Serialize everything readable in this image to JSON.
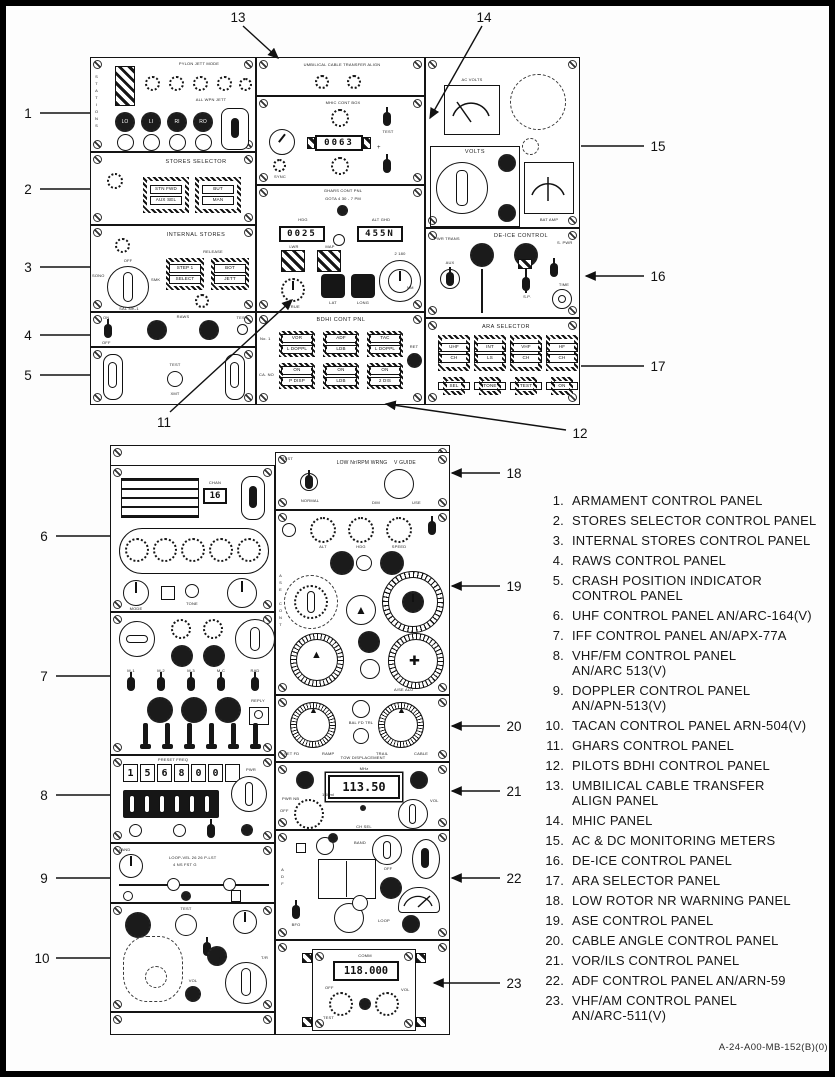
{
  "doc": {
    "footer_code": "A-24-A00-MB-152(B)(0)"
  },
  "callouts": [
    "1",
    "2",
    "3",
    "4",
    "5",
    "6",
    "7",
    "8",
    "9",
    "10",
    "11",
    "12",
    "13",
    "14",
    "15",
    "16",
    "17",
    "18",
    "19",
    "20",
    "21",
    "22",
    "23"
  ],
  "legend": {
    "items": [
      {
        "num": "1.",
        "l1": "ARMAMENT CONTROL PANEL",
        "l2": ""
      },
      {
        "num": "2.",
        "l1": "STORES SELECTOR CONTROL PANEL",
        "l2": ""
      },
      {
        "num": "3.",
        "l1": "INTERNAL STORES CONTROL PANEL",
        "l2": ""
      },
      {
        "num": "4.",
        "l1": "RAWS CONTROL PANEL",
        "l2": ""
      },
      {
        "num": "5.",
        "l1": "CRASH POSITION INDICATOR",
        "l2": "CONTROL PANEL"
      },
      {
        "num": "6.",
        "l1": "UHF CONTROL PANEL AN/ARC-164(V)",
        "l2": ""
      },
      {
        "num": "7.",
        "l1": "IFF CONTROL PANEL AN/APX-77A",
        "l2": ""
      },
      {
        "num": "8.",
        "l1": "VHF/FM CONTROL PANEL",
        "l2": "AN/ARC 513(V)"
      },
      {
        "num": "9.",
        "l1": "DOPPLER CONTROL PANEL",
        "l2": "AN/APN-513(V)"
      },
      {
        "num": "10.",
        "l1": "TACAN CONTROL PANEL ARN-504(V)",
        "l2": ""
      },
      {
        "num": "11.",
        "l1": "GHARS CONTROL PANEL",
        "l2": ""
      },
      {
        "num": "12.",
        "l1": "PILOTS BDHI CONTROL PANEL",
        "l2": ""
      },
      {
        "num": "13.",
        "l1": "UMBILICAL CABLE TRANSFER",
        "l2": "ALIGN PANEL"
      },
      {
        "num": "14.",
        "l1": "MHIC PANEL",
        "l2": ""
      },
      {
        "num": "15.",
        "l1": "AC & DC MONITORING METERS",
        "l2": ""
      },
      {
        "num": "16.",
        "l1": "DE-ICE CONTROL PANEL",
        "l2": ""
      },
      {
        "num": "17.",
        "l1": "ARA SELECTOR PANEL",
        "l2": ""
      },
      {
        "num": "18.",
        "l1": "LOW ROTOR NR WARNING PANEL",
        "l2": ""
      },
      {
        "num": "19.",
        "l1": "ASE CONTROL PANEL",
        "l2": ""
      },
      {
        "num": "20.",
        "l1": "CABLE ANGLE CONTROL PANEL",
        "l2": ""
      },
      {
        "num": "21.",
        "l1": "VOR/ILS CONTROL PANEL",
        "l2": ""
      },
      {
        "num": "22.",
        "l1": "ADF CONTROL PANEL AN/ARN-59",
        "l2": ""
      },
      {
        "num": "23.",
        "l1": "VHF/AM CONTROL PANEL",
        "l2": "AN/ARC-511(V)"
      }
    ]
  },
  "panels": {
    "p1": {
      "title": "PYLON JETT MODE",
      "jett": "ALL WPN JETT",
      "side": "STATIONS",
      "stations": [
        "LO",
        "LI",
        "RI",
        "RO"
      ]
    },
    "p2": {
      "title": "STORES SELECTOR",
      "b1": [
        "STN FWD",
        "AUX SEL"
      ],
      "b2": [
        "BUT",
        "MAN"
      ]
    },
    "p3": {
      "title": "INTERNAL STORES",
      "release": "RELEASE",
      "off": "OFF",
      "sono": "SONO",
      "smk": "SMK",
      "sal": "SAL MK-1",
      "b1": [
        "STEP 1",
        "SELECT"
      ],
      "b2": [
        "BOT",
        "JETT"
      ]
    },
    "p4": {
      "on": "ON",
      "off": "OFF",
      "title": "RAWS",
      "test": "TEST"
    },
    "p5": {
      "test": "TEST",
      "xmt": "XMT"
    },
    "p13": {
      "title": "UMBILICAL CABLE TRANSFER ALIGN"
    },
    "p14": {
      "title": "MHIC CONT BOX",
      "counter": "0063",
      "sync": "SYNC",
      "plus": "+",
      "test": "TEST"
    },
    "p11": {
      "title": "GHARS CONT PNL",
      "note": "GOTA 4 30 - 7 PM",
      "hdg": "HDG",
      "lat": "ALT GHD",
      "d1": "0025",
      "d2": "455N",
      "lwr": "LWR",
      "map": "MAP",
      "true": "TRUE",
      "k1": "LAT",
      "k2": "LONG",
      "set": "2 180",
      "nm": "NM"
    },
    "p12": {
      "title": "BDHI CONT PNL",
      "no1": "No. 1",
      "cano": "CA. NO",
      "ret": "RET",
      "btns": [
        [
          "VOR",
          "L DOPPL"
        ],
        [
          "ADF",
          "LDB"
        ],
        [
          "TAC",
          "L DOPPL"
        ],
        [
          "ON",
          "P DISP"
        ],
        [
          "ON",
          "LDB"
        ],
        [
          "ON",
          "2 DIS"
        ]
      ]
    },
    "p15": {
      "ac": "AC VOLTS",
      "volts": "VOLTS",
      "bat": "BAT AMP"
    },
    "p16": {
      "title": "DE-ICE CONTROL",
      "pwr": "PWR TRANS",
      "aux": "AUX",
      "sp": "S.P.",
      "spwr": "S. PWR",
      "time": "TIME"
    },
    "p17": {
      "title": "ARA SELECTOR",
      "btns": [
        [
          "UHF",
          "CH"
        ],
        [
          "INT",
          "LS"
        ],
        [
          "VHF",
          "CH"
        ],
        [
          "HF",
          "CH"
        ]
      ],
      "subs": [
        "SEL",
        "TONE",
        "TEST",
        "ON"
      ]
    },
    "p6": {
      "preset": "16",
      "chan": "CHAN",
      "mode": "MODE",
      "tone": "TONE"
    },
    "p7": {
      "modes": [
        "M-1",
        "M-2",
        "M-3",
        "M-C",
        "RAD"
      ],
      "reply": "REPLY"
    },
    "p8": {
      "hdr": "PRESET FREQ",
      "digits": [
        "1",
        "5",
        "6",
        "8",
        "0",
        "0"
      ],
      "pwr": "PWR"
    },
    "p9": {
      "land": "LAND",
      "l1": "LOOP-VEL 26 26 P-LST",
      "l2": "4 NS FST G"
    },
    "p10": {
      "test": "TEST",
      "off": "OFF",
      "tr": "T/R",
      "vol": "VOL"
    },
    "p18": {
      "test": "TEST",
      "title": "LOW Nr/RPM WRNG",
      "vg": "V GUIDE",
      "normal": "NORMAL",
      "dim": "DIM",
      "use": "USE"
    },
    "p19": {
      "vert": "ASE CONT",
      "k1": "ALT",
      "k2": "HDG",
      "k3": "SPEED",
      "adj": "A/SE ADJ"
    },
    "p20": {
      "l1": "SET FD",
      "l2": "RAMP",
      "r1": "TRAIL",
      "r2": "CABLE",
      "c": "BAL FD TRL",
      "bot": "TOW DISPLACEMENT"
    },
    "p21": {
      "mhz": "MHz",
      "d": "113.50",
      "pwr": "PWR NB",
      "off": "OFF",
      "ml": "1.0 ml",
      "vol": "VOL",
      "ch": "CH SEL"
    },
    "p22": {
      "adf": "ADF",
      "band": "BAND",
      "off": "OFF",
      "loop": "LOOP",
      "bfo": "BFO"
    },
    "p23": {
      "comm": "COMM",
      "d": "118.000",
      "off": "OFF",
      "test": "TEST",
      "vol": "VOL"
    }
  }
}
